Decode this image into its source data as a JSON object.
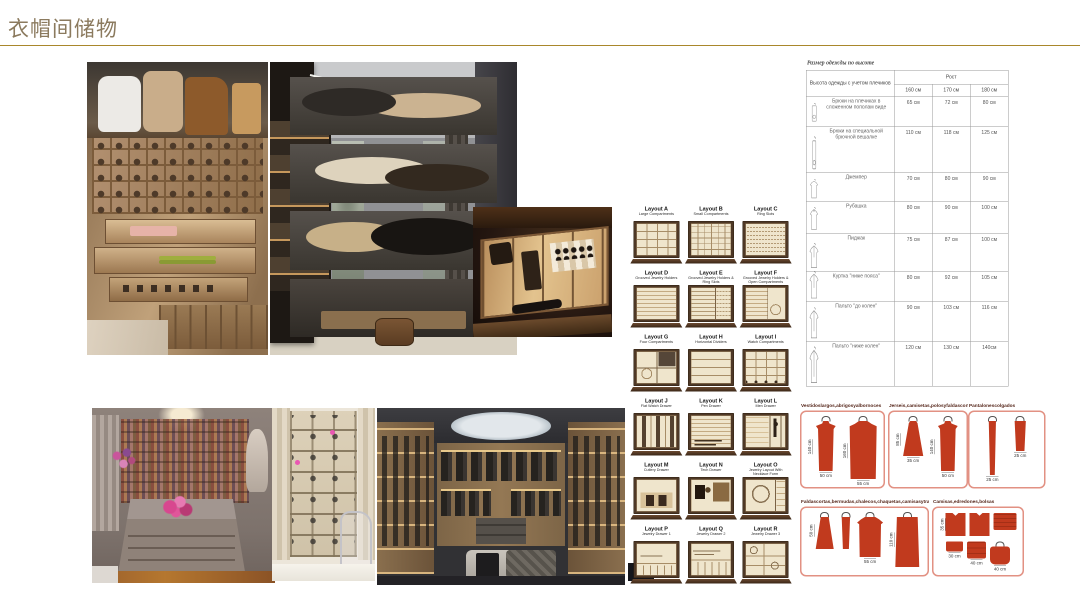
{
  "slide": {
    "title": "衣帽间储物"
  },
  "colors": {
    "title": "#8b7a5e",
    "rule": "#a9872b",
    "garment_red": "#c13a1e",
    "diagram_border": "#e29183"
  },
  "photos": [
    {
      "name": "photo-shoe-shelves",
      "desc": "wood closet with handbags, shoe cubbies and pull-out accessory drawers"
    },
    {
      "name": "photo-hat-tower-room",
      "desc": "dressing room with tall glass hat display tower"
    },
    {
      "name": "photo-watch-drawer",
      "desc": "pull-out drawer with watches and glasses"
    },
    {
      "name": "photo-island-closet",
      "desc": "luxury walk-in closet with island and shoe wall"
    },
    {
      "name": "photo-shoebox-cabinet",
      "desc": "cream shoe-box cabinet with curtains and clear chair"
    },
    {
      "name": "photo-walkin-skylight",
      "desc": "modern walk-in wardrobe with round skylight and bench"
    }
  ],
  "layouts": {
    "items": [
      {
        "id": "A",
        "label": "Layout A",
        "subtitle": "Large Compartments",
        "pattern": "grid4"
      },
      {
        "id": "B",
        "label": "Layout B",
        "subtitle": "Small Compartments",
        "pattern": "grid6"
      },
      {
        "id": "C",
        "label": "Layout C",
        "subtitle": "Ring Slots",
        "pattern": "rings"
      },
      {
        "id": "D",
        "label": "Layout D",
        "subtitle": "Grooved Jewelry Holders",
        "pattern": "grooves"
      },
      {
        "id": "E",
        "label": "Layout E",
        "subtitle": "Grooved Jewelry Holders & Ring Slots",
        "pattern": "grooves-rings"
      },
      {
        "id": "F",
        "label": "Layout F",
        "subtitle": "Grooved Jewelry Holders & Open Compartments",
        "pattern": "grooves-open"
      },
      {
        "id": "G",
        "label": "Layout G",
        "subtitle": "Four Compartments",
        "pattern": "four"
      },
      {
        "id": "H",
        "label": "Layout H",
        "subtitle": "Horizontal Dividers",
        "pattern": "hdiv"
      },
      {
        "id": "I",
        "label": "Layout I",
        "subtitle": "Watch Compartments",
        "pattern": "watch"
      },
      {
        "id": "J",
        "label": "Layout J",
        "subtitle": "Flat Watch Drawer",
        "pattern": "flatwatch"
      },
      {
        "id": "K",
        "label": "Layout K",
        "subtitle": "Pen Drawer",
        "pattern": "pen"
      },
      {
        "id": "L",
        "label": "Layout L",
        "subtitle": "Men Drawer",
        "pattern": "men"
      },
      {
        "id": "M",
        "label": "Layout M",
        "subtitle": "Cutlery Drawer",
        "pattern": "cutlery"
      },
      {
        "id": "N",
        "label": "Layout N",
        "subtitle": "Tech Drawer",
        "pattern": "tech"
      },
      {
        "id": "O",
        "label": "Layout O",
        "subtitle": "Jewelry Layout With Necklace Form",
        "pattern": "necklace"
      },
      {
        "id": "P",
        "label": "Layout P",
        "subtitle": "Jewelry Drawer 1",
        "pattern": "jd1"
      },
      {
        "id": "Q",
        "label": "Layout Q",
        "subtitle": "Jewelry Drawer 2",
        "pattern": "jd2"
      },
      {
        "id": "R",
        "label": "Layout R",
        "subtitle": "Jewelry Drawer 3",
        "pattern": "jd3"
      }
    ]
  },
  "size_table": {
    "title": "Размер одежды по высоте",
    "col1_header": "Высота одежды с учетом плечиков",
    "group_header": "Рост",
    "height_cols": [
      "160 см",
      "170 см",
      "180 см"
    ],
    "rows": [
      {
        "icon": "trousers-folded",
        "label": "Брюки на плечиках в сложенном пополам виде",
        "values": [
          "65 см",
          "72 см",
          "80 см"
        ]
      },
      {
        "icon": "trousers-long",
        "label": "Брюки на специальной брючной вешалке",
        "values": [
          "110 см",
          "118 см",
          "125 см"
        ]
      },
      {
        "icon": "sweater",
        "label": "Джемпер",
        "values": [
          "70 см",
          "80 см",
          "90 см"
        ]
      },
      {
        "icon": "shirt",
        "label": "Рубашка",
        "values": [
          "80 см",
          "90 см",
          "100 см"
        ]
      },
      {
        "icon": "jacket",
        "label": "Пиджак",
        "values": [
          "75 см",
          "87 см",
          "100 см"
        ]
      },
      {
        "icon": "jacket-long",
        "label": "Куртка \"ниже пояса\"",
        "values": [
          "80 см",
          "92 см",
          "105 см"
        ]
      },
      {
        "icon": "coat",
        "label": "Пальто \"до колен\"",
        "values": [
          "90 см",
          "103 см",
          "116 см"
        ]
      },
      {
        "icon": "coat-long",
        "label": "Пальто \"ниже колен\"",
        "values": [
          "120 см",
          "130 см",
          "140см"
        ]
      }
    ]
  },
  "garment_boxes": [
    {
      "title": "Vestidoslargos,abrigosyalbornoces",
      "items": [
        {
          "type": "dress",
          "h": "140 cm",
          "w": "50 cm"
        },
        {
          "type": "coat",
          "h": "160 cm",
          "w": "55 cm"
        }
      ]
    },
    {
      "title": "Jerseis,camisetas,polosyfaldascortas",
      "items": [
        {
          "type": "top",
          "h": "85 cm",
          "w": "35 cm"
        },
        {
          "type": "dress",
          "h": "140 cm",
          "w": "50 cm"
        }
      ]
    },
    {
      "title": "Pantalonescolgados",
      "items": [
        {
          "type": "trouser-long",
          "w": "25 cm"
        },
        {
          "type": "trouser-half",
          "w": "25 cm"
        }
      ]
    },
    {
      "title": "Faldascortas,bermudas,chalecos,chaquetas,camisasytrajes",
      "items": [
        {
          "type": "skirt",
          "h": "50 cm"
        },
        {
          "type": "trouser-folded"
        },
        {
          "type": "jacket",
          "w": "55 cm"
        },
        {
          "type": "suit",
          "h": "110 cm"
        }
      ]
    },
    {
      "title": "Camisas,edredones,bolsas",
      "items": [
        {
          "type": "folded-shirt",
          "h": "35 cm"
        },
        {
          "type": "folded-shirt2"
        },
        {
          "type": "blanket"
        },
        {
          "type": "folded-small",
          "w": "30 cm"
        },
        {
          "type": "duvet",
          "w": "40 cm"
        },
        {
          "type": "bag",
          "w": "40 cm"
        }
      ]
    }
  ]
}
